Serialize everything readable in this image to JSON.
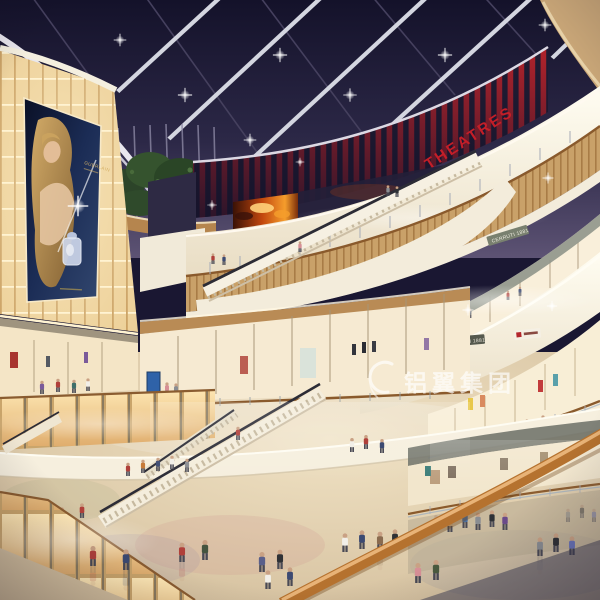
{
  "scene": {
    "signs": {
      "theatre_marquee": "THEATRES",
      "billboard_brand": "GUERLAIN",
      "shop_sign_upper_right": "CERRUTI 1881",
      "shop_sign_mid_right": "CERRUTI 1881"
    },
    "watermark": {
      "logo": "swirl-mark",
      "text": "铝翼集团"
    },
    "colors": {
      "night_sky": "#1a1732",
      "marquee_red": "#b3232b",
      "fascia_cream": "#f6efde",
      "wood": "#c49a63",
      "glow_amber": "#ffdf9e",
      "floor": "#d9c6a6",
      "handrail_wood": "#b5722f"
    }
  }
}
